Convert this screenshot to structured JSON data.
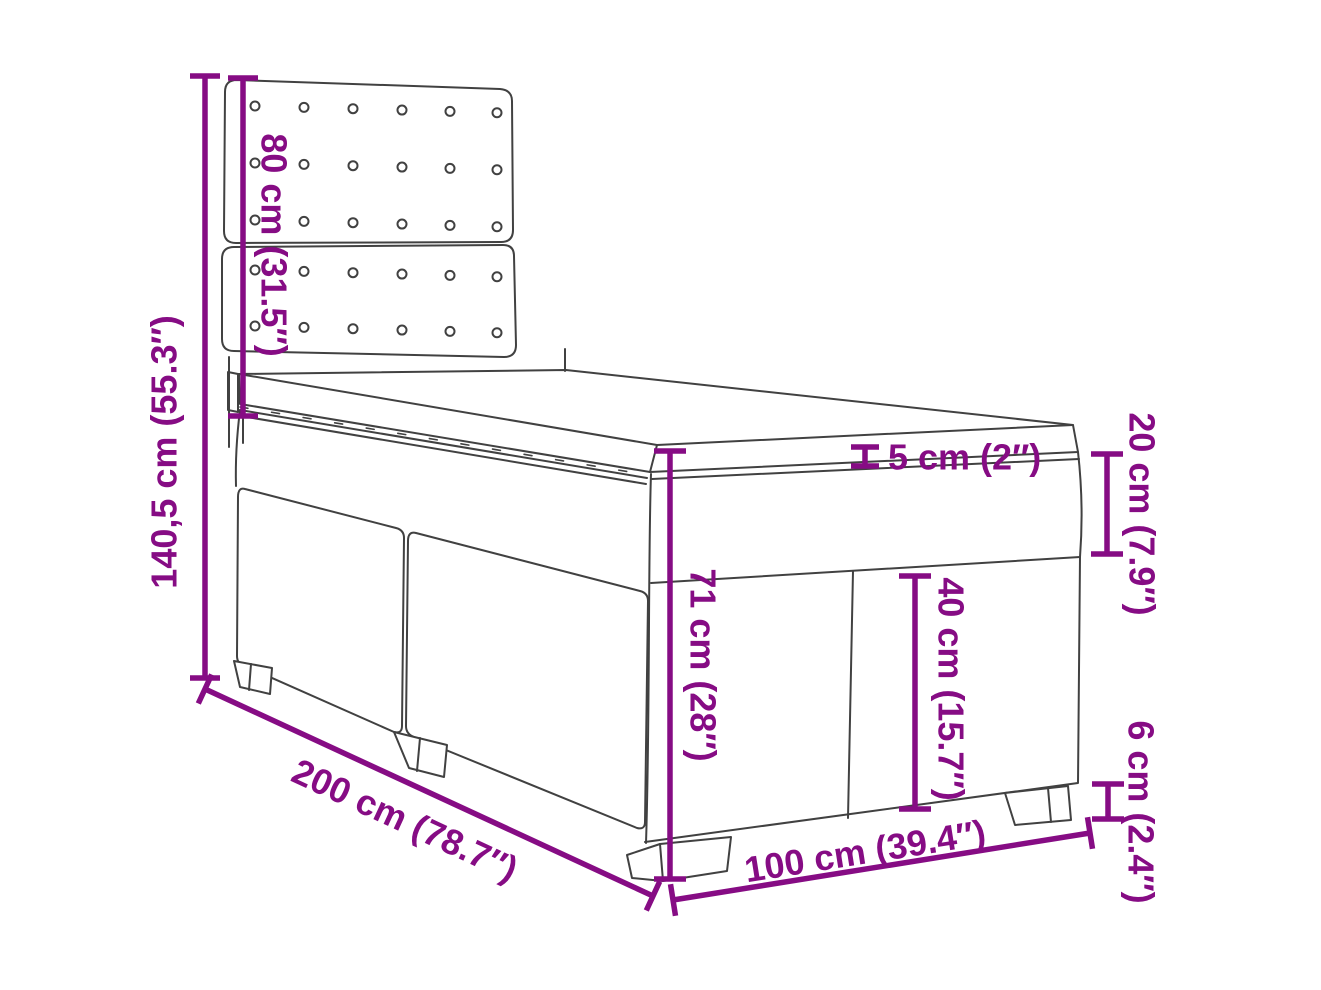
{
  "colors": {
    "accent": "#860C84",
    "line": "#414141",
    "background": "#FFFFFF"
  },
  "diagram": {
    "subject": "box-spring-bed-with-headboard-and-topper",
    "dimensions": {
      "total_height": "140,5 cm (55.3″)",
      "headboard_height": "80 cm (31.5″)",
      "bed_length": "200 cm (78.7″)",
      "bed_width": "100 cm (39.4″)",
      "side_height": "71 cm (28″)",
      "base_height": "40 cm (15.7″)",
      "mattress_height": "20 cm (7.9″)",
      "leg_height": "6 cm (2.4″)",
      "topper_height": "5 cm (2″)"
    }
  }
}
